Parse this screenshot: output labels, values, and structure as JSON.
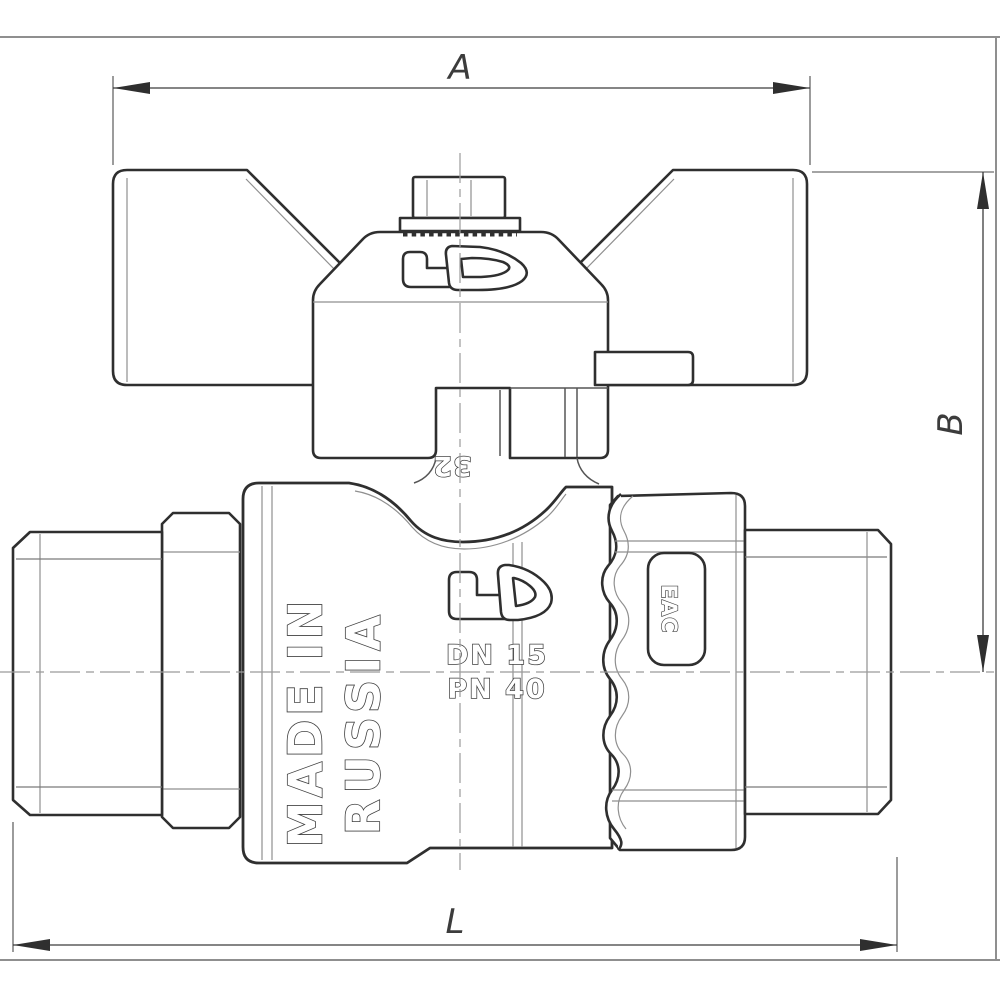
{
  "drawing": {
    "title": "Ball valve with butterfly handle - front view technical drawing",
    "dim_labels": {
      "A": "A",
      "B": "B",
      "L": "L"
    },
    "markings": {
      "brand": "LD",
      "made_in_line1": "MADE IN",
      "made_in_line2": "RUSSIA",
      "nominal_diameter": "DN 15",
      "pressure_rating": "PN 40",
      "handle_size": "32",
      "certification": "EAC"
    },
    "colors": {
      "line": "#2f2f2f",
      "thin_line": "#8f8f8f",
      "centerline": "#9b9b9b",
      "dimension": "#3c3c3c",
      "background": "#ffffff"
    }
  }
}
